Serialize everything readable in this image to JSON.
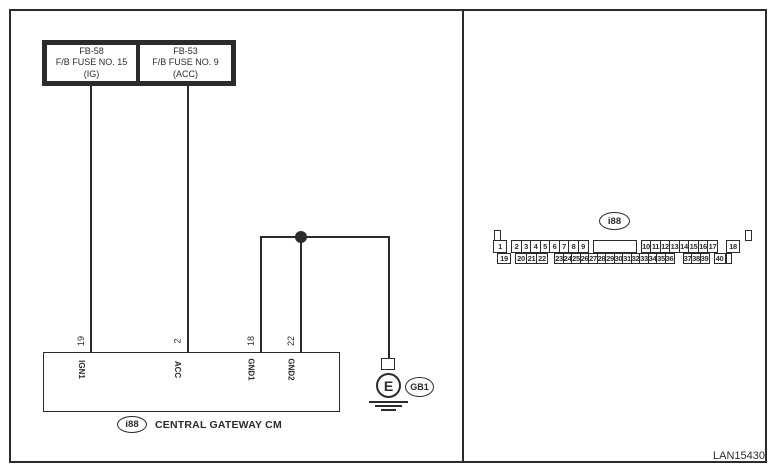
{
  "page": {
    "code_label": "LAN15430"
  },
  "colors": {
    "line": "#2b2b2b",
    "background": "#ffffff"
  },
  "left_panel": {
    "fuse_boxes": [
      {
        "id": "FB-58",
        "name": "F/B FUSE NO. 15",
        "circuit": "(IG)"
      },
      {
        "id": "FB-53",
        "name": "F/B FUSE NO. 9",
        "circuit": "(ACC)"
      }
    ],
    "module": {
      "connector_id": "i88",
      "name": "CENTRAL GATEWAY CM",
      "pins": [
        {
          "number": "19",
          "name": "IGN1"
        },
        {
          "number": "2",
          "name": "ACC"
        },
        {
          "number": "18",
          "name": "GND1"
        },
        {
          "number": "22",
          "name": "GND2"
        }
      ]
    },
    "ground": {
      "symbol": "E",
      "id": "GB1"
    }
  },
  "right_panel": {
    "connector_id": "i88",
    "pinout": {
      "top_row_groups": [
        [
          "1"
        ],
        [
          "2",
          "3",
          "4",
          "5",
          "6",
          "7",
          "8",
          "9"
        ],
        [
          ""
        ],
        [
          "10",
          "11",
          "12",
          "13",
          "14",
          "15",
          "16",
          "17"
        ],
        [
          "18"
        ]
      ],
      "bottom_row_groups": [
        [
          "19"
        ],
        [
          "20",
          "21",
          "22"
        ],
        [
          "23",
          "24",
          "25",
          "26",
          "27",
          "28",
          "29",
          "30",
          "31",
          "32",
          "33",
          "34",
          "35",
          "36"
        ],
        [
          "37",
          "38",
          "39"
        ],
        [
          "40"
        ],
        [
          ""
        ]
      ]
    }
  }
}
